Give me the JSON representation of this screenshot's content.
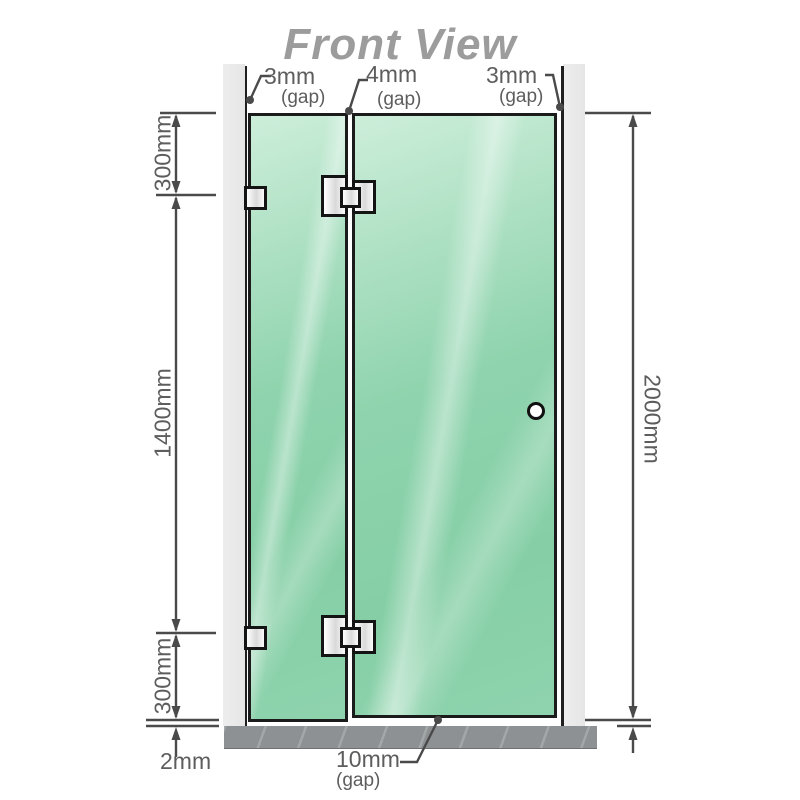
{
  "title": "Front View",
  "labels": {
    "top_gaps": [
      {
        "value": "3mm",
        "unit": "(gap)"
      },
      {
        "value": "4mm",
        "unit": "(gap)"
      },
      {
        "value": "3mm",
        "unit": "(gap)"
      }
    ],
    "left": {
      "top": "300mm",
      "middle": "1400mm",
      "bottom": "300mm",
      "floor_gap": "2mm"
    },
    "right": {
      "height": "2000mm"
    },
    "bottom_gap": {
      "value": "10mm",
      "unit": "(gap)"
    }
  },
  "colors": {
    "glass": "#8ed3ad",
    "glass_hi": "#cdeeda",
    "wall": "#eaeaea",
    "wall_line": "#1f1f1f",
    "floor": "#8d9193",
    "title_text": "#9c9c9c",
    "label_text": "#5d5d5d",
    "line": "#4a4a4a",
    "hinge_border": "#141414",
    "watermark": "#7d1822"
  }
}
